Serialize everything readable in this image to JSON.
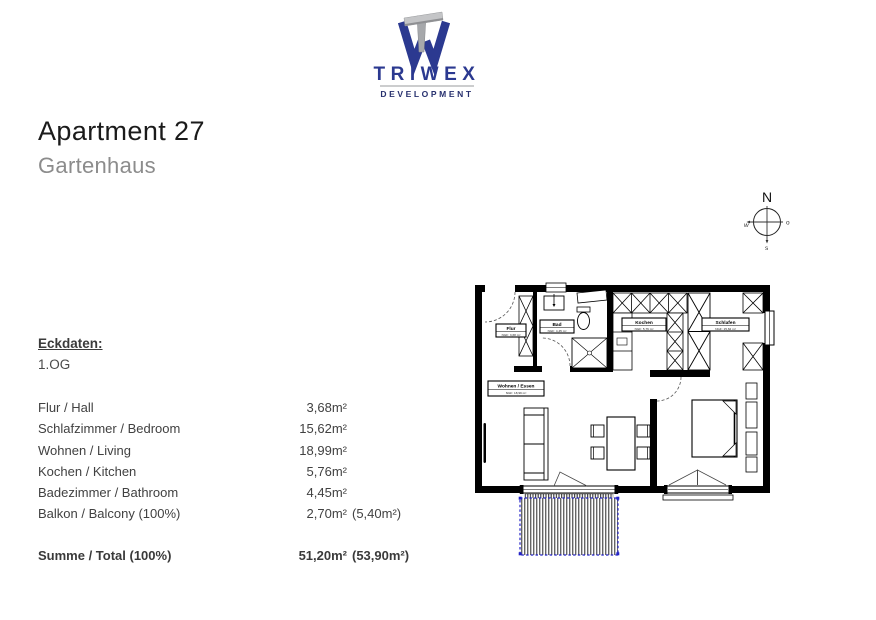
{
  "logo": {
    "name": "TRIWEX",
    "tagline": "DEVELOPMENT"
  },
  "header": {
    "title": "Apartment 27",
    "subtitle": "Gartenhaus"
  },
  "compass": {
    "north": "N",
    "east": "o",
    "south": "s",
    "west": "w"
  },
  "eckdaten": {
    "heading": "Eckdaten:",
    "floor": "1.OG"
  },
  "rooms": [
    {
      "label": "Flur / Hall",
      "value": "3,68m²"
    },
    {
      "label": "Schlafzimmer / Bedroom",
      "value": "15,62m²"
    },
    {
      "label": "Wohnen / Living",
      "value": "18,99m²"
    },
    {
      "label": "Kochen / Kitchen",
      "value": "5,76m²"
    },
    {
      "label": "Badezimmer / Bathroom",
      "value": "4,45m²"
    },
    {
      "label": "Balkon / Balcony (100%)",
      "value": "2,70m²",
      "extra": "(5,40m²)"
    }
  ],
  "total": {
    "label": "Summe / Total (100%)",
    "value": "51,20m²",
    "extra": "(53,90m²)"
  },
  "floorplan": {
    "rooms": [
      {
        "name": "Flur",
        "area": "NGF: 3,68 m²"
      },
      {
        "name": "Bad",
        "area": "NGF: 4,45 m²"
      },
      {
        "name": "Kochen",
        "area": "NGF: 5,76 m²"
      },
      {
        "name": "Schlafen",
        "area": "NGF: 15,62 m²"
      },
      {
        "name": "Wohnen / Essen",
        "area": "NGF: 18,99 m²"
      }
    ]
  },
  "colors": {
    "brand_blue": "#2b3990",
    "logo_gray": "#a7a9ac",
    "subtitle_gray": "#8c8c8c",
    "balcony_blue": "#2323c8"
  }
}
